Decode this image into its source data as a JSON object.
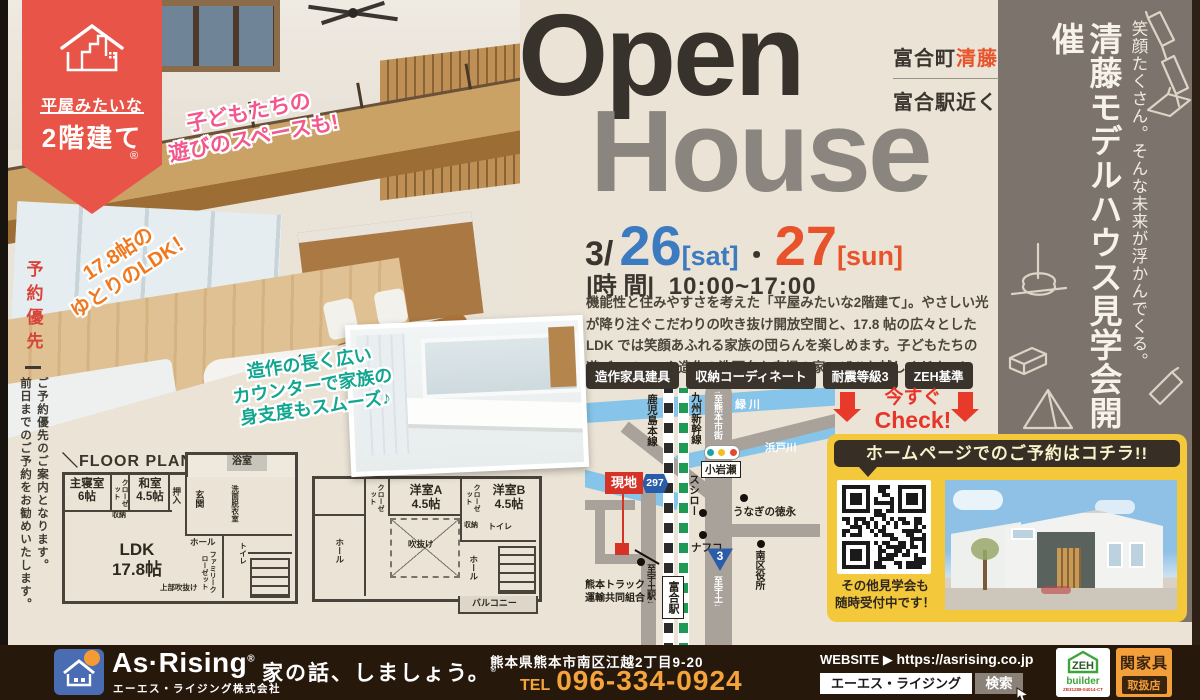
{
  "brand_ribbon": {
    "top": "平屋みたいな",
    "bottom": "2階建て",
    "reg": "®"
  },
  "reservation": {
    "title": "予約優先",
    "note": "ご予約優先のご案内となります。\n前日までのご予約をお勧めいたします。"
  },
  "photo_callouts": {
    "kids": "子どもたちの\n遊びのスペースも!",
    "ldk": "17.8帖の\nゆとりのLDK！",
    "counter": "造作の長く広い\nカウンターで家族の\n身支度もスムーズ♪"
  },
  "title": {
    "en1": "Open",
    "en2": "House",
    "area_main": "富合町",
    "area_accent": "清藤",
    "area_sub": "富合駅近く"
  },
  "event": {
    "month": "3/",
    "day1": "26",
    "day1_tag": "[sat]",
    "dot": "・",
    "day2": "27",
    "day2_tag": "[sun]",
    "time_label": "|時 間|",
    "time": "10:00~17:00",
    "description": "機能性と住みやすさを考えた「平屋みたいな2階建て」。やさしい光が降り注ぐこだわりの吹き抜け開放空間と、17.8 帖の広々としたLDK では笑顔あふれる家族の団らんを楽しめます。子どもたちの遊びスペースや造作の洗面台も自慢の家。ぜひお越しください！",
    "badges": [
      "造作家具建具",
      "収納コーディネート",
      "耐震等級3",
      "ZEH基準"
    ]
  },
  "side_panel": {
    "headline": "清藤モデルハウス見学会開催",
    "subline": "笑顔たくさん。そんな未来が浮かんでくる。"
  },
  "floor_plan": {
    "title": "＼FLOOR PLAN／",
    "f1": {
      "bedroom": "主寝室\n6帖",
      "closet": "クローゼット",
      "storage": "収納",
      "washitsu": "和室\n4.5帖",
      "oshiire": "押入",
      "genkan": "玄関",
      "bath": "浴室",
      "wash_room": "洗面脱衣室",
      "hall": "ホール",
      "family_closet": "ファミリークローゼット",
      "toilet": "トイレ",
      "ldk": "LDK\n17.8帖",
      "void_note": "上部吹抜け"
    },
    "f2": {
      "closet1": "クローゼット",
      "room_a": "洋室A\n4.5帖",
      "closet2": "クローゼット",
      "room_b": "洋室B\n4.5帖",
      "void": "吹抜け",
      "hall1": "ホール",
      "storage": "収納",
      "toilet": "トイレ",
      "hall2": "ホール",
      "balcony": "バルコニー"
    }
  },
  "map": {
    "rail_local": "鹿児島本線",
    "rail_shinkansen": "九州新幹線",
    "to_city": "↑至熊本市街",
    "river1": "緑川",
    "river2": "浜戸川",
    "junction": "小岩瀬",
    "sushiro": "スシロー",
    "unagi": "うなぎの徳永",
    "nafco": "ナフコ",
    "ward_office": "南区役所",
    "route297": "297",
    "route3": "3",
    "site": "現地",
    "truck": "熊本トラック\n運輸共同組合",
    "to_uto_station": "至宇土駅↓",
    "station": "富合駅",
    "to_uto": "至宇土↓"
  },
  "promo": {
    "check_line1": "今すぐ",
    "check_line2": "Check!",
    "header": "ホームページでのご予約はコチラ!!",
    "qr_note": "その他見学会も\n随時受付中です！"
  },
  "footer": {
    "company_en": "As·Rising",
    "reg": "®",
    "company_jp": "エーエス・ライジング株式会社",
    "tagline": "家の話、しましょう。",
    "tagline_reg": "®",
    "address": "熊本県熊本市南区江越2丁目9-20",
    "tel_label": "TEL",
    "tel_number": "096-334-0924",
    "website_label": "WEBSITE",
    "website_url": "https://asrising.co.jp",
    "search_text": "エーエス・ライジング",
    "search_button": "検索",
    "zeh_line1": "ZEH",
    "zeh_line2": "builder",
    "zeh_code": "ZB31288-04014-CT",
    "dealer_name": "関家具",
    "dealer_sub": "取扱店"
  }
}
